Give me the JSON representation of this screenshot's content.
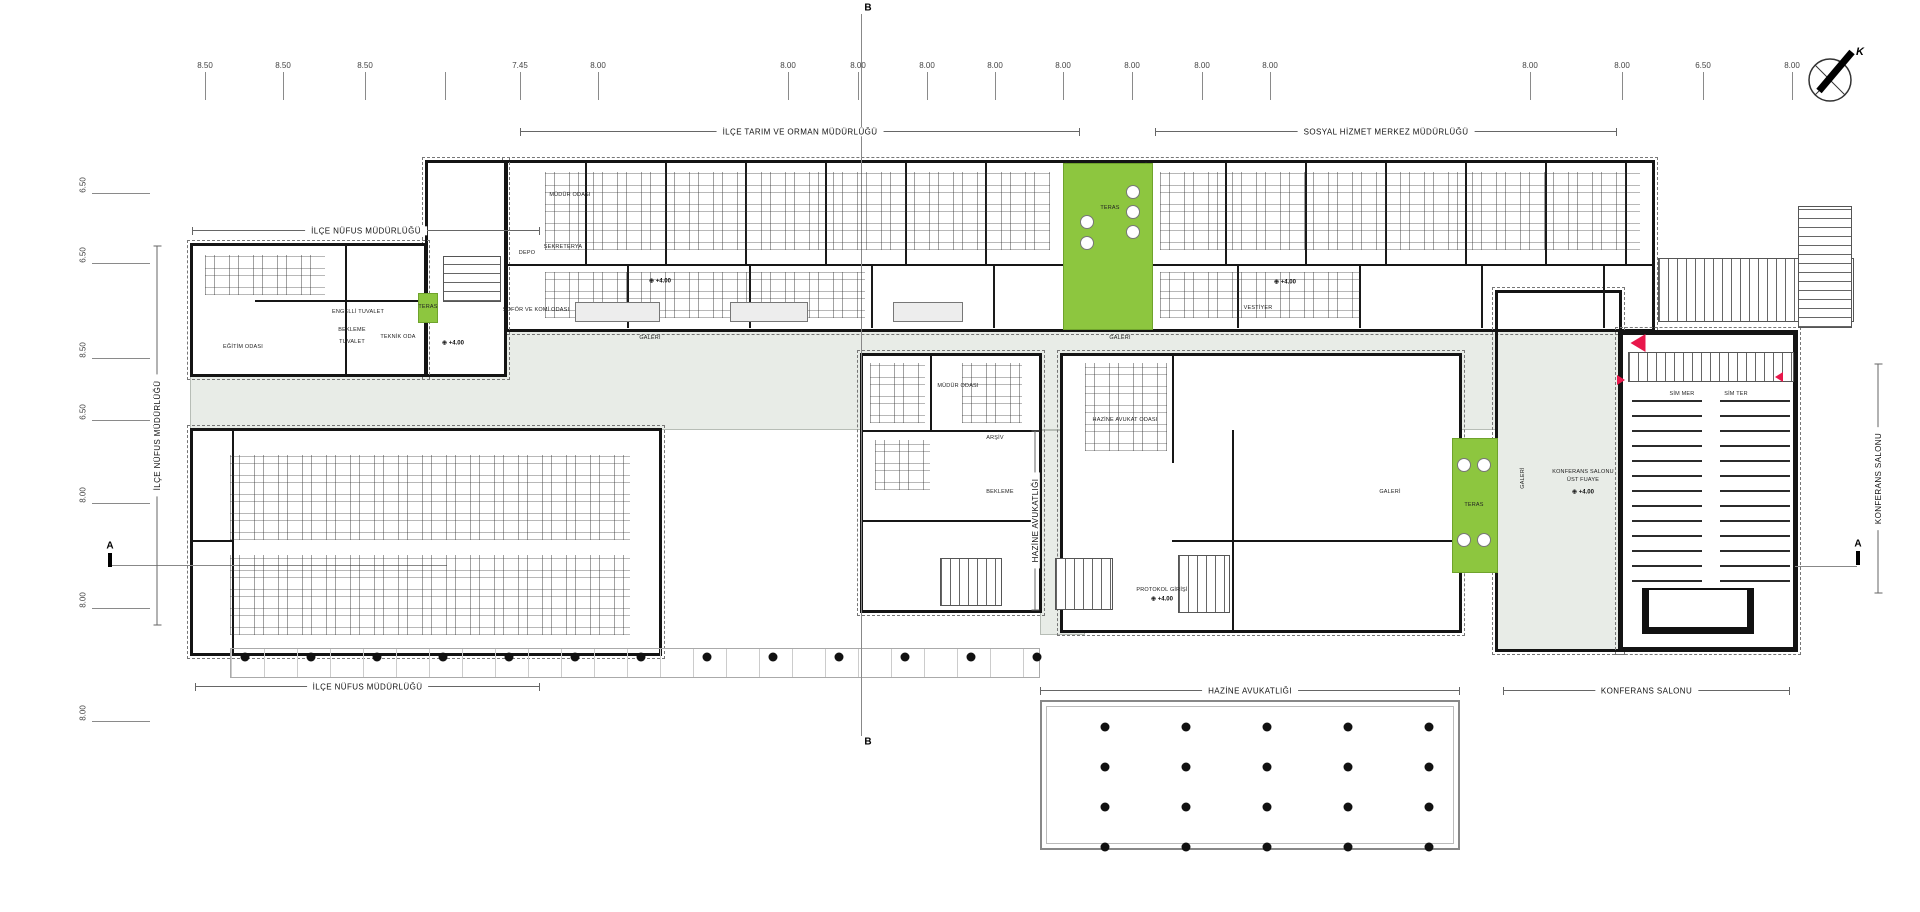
{
  "colors": {
    "green": "#8dc63f",
    "red": "#e8174b",
    "corridor": "#e8ece7",
    "wall": "#141414"
  },
  "compass": {
    "label": "K"
  },
  "sections": {
    "a": "A",
    "b": "B"
  },
  "dims_top": [
    {
      "x": 205,
      "v": "8.50"
    },
    {
      "x": 283,
      "v": "8.50"
    },
    {
      "x": 365,
      "v": "8.50"
    },
    {
      "x": 445,
      "v": ""
    },
    {
      "x": 520,
      "v": "7.45"
    },
    {
      "x": 598,
      "v": "8.00"
    },
    {
      "x": 788,
      "v": "8.00"
    },
    {
      "x": 858,
      "v": "8.00"
    },
    {
      "x": 927,
      "v": "8.00"
    },
    {
      "x": 995,
      "v": "8.00"
    },
    {
      "x": 1063,
      "v": "8.00"
    },
    {
      "x": 1132,
      "v": "8.00"
    },
    {
      "x": 1202,
      "v": "8.00"
    },
    {
      "x": 1270,
      "v": "8.00"
    },
    {
      "x": 1530,
      "v": "8.00"
    },
    {
      "x": 1622,
      "v": "8.00"
    },
    {
      "x": 1703,
      "v": "6.50"
    },
    {
      "x": 1792,
      "v": "8.00"
    }
  ],
  "dims_left": [
    {
      "y": 185,
      "v": "6.50"
    },
    {
      "y": 255,
      "v": "6.50"
    },
    {
      "y": 350,
      "v": "8.50"
    },
    {
      "y": 412,
      "v": "6.50"
    },
    {
      "y": 495,
      "v": "8.00"
    },
    {
      "y": 600,
      "v": "8.00"
    },
    {
      "y": 713,
      "v": "8.00"
    }
  ],
  "dept_lines": [
    {
      "x1": 520,
      "x2": 1080,
      "y": 131,
      "t": "İLÇE TARIM VE ORMAN MÜDÜRLÜĞÜ"
    },
    {
      "x1": 1155,
      "x2": 1617,
      "y": 131,
      "t": "SOSYAL HİZMET MERKEZ MÜDÜRLÜĞÜ"
    },
    {
      "x1": 192,
      "x2": 540,
      "y": 230,
      "t": "İLÇE NÜFUS MÜDÜRLÜĞÜ"
    },
    {
      "x1": 195,
      "x2": 540,
      "y": 686,
      "t": "İLÇE NÜFUS MÜDÜRLÜĞÜ"
    },
    {
      "x1": 1040,
      "x2": 1460,
      "y": 690,
      "t": "HAZİNE AVUKATLIĞI"
    },
    {
      "x1": 1503,
      "x2": 1790,
      "y": 690,
      "t": "KONFERANS SALONU"
    }
  ],
  "side_labels": [
    {
      "x": 157,
      "y": 435,
      "len": 380,
      "t": "İLÇE NÜFUS MÜDÜRLÜĞÜ"
    },
    {
      "x": 1035,
      "y": 520,
      "len": 180,
      "t": "HAZİNE AVUKATLIĞI"
    },
    {
      "x": 1878,
      "y": 478,
      "len": 230,
      "t": "KONFERANS SALONU"
    }
  ],
  "room_labels": [
    {
      "x": 650,
      "y": 338,
      "t": "GALERİ"
    },
    {
      "x": 1120,
      "y": 338,
      "t": "GALERİ"
    },
    {
      "x": 1390,
      "y": 492,
      "t": "GALERİ"
    },
    {
      "x": 1523,
      "y": 478,
      "t": "GALERİ",
      "rot": -90
    },
    {
      "x": 352,
      "y": 330,
      "t": "BEKLEME"
    },
    {
      "x": 1000,
      "y": 492,
      "t": "BEKLEME"
    },
    {
      "x": 358,
      "y": 312,
      "t": "ENGELLİ TUVALET"
    },
    {
      "x": 352,
      "y": 342,
      "t": "TUVALET"
    },
    {
      "x": 398,
      "y": 337,
      "t": "TEKNİK ODA"
    },
    {
      "x": 243,
      "y": 347,
      "t": "EĞİTİM ODASI"
    },
    {
      "x": 563,
      "y": 247,
      "t": "SEKRETERYA"
    },
    {
      "x": 527,
      "y": 253,
      "t": "DEPO"
    },
    {
      "x": 570,
      "y": 195,
      "t": "MÜDÜR ODASI"
    },
    {
      "x": 536,
      "y": 310,
      "t": "ŞOFÖR VE KOMİ ODASI"
    },
    {
      "x": 1258,
      "y": 308,
      "t": "VESTİYER"
    },
    {
      "x": 1125,
      "y": 420,
      "t": "HAZİNE AVUKAT ODASI"
    },
    {
      "x": 958,
      "y": 386,
      "t": "MÜDÜR ODASI"
    },
    {
      "x": 995,
      "y": 438,
      "t": "ARŞİV"
    },
    {
      "x": 1162,
      "y": 590,
      "t": "PROTOKOL GİRİŞİ"
    },
    {
      "x": 1682,
      "y": 394,
      "t": "SİM MER"
    },
    {
      "x": 1736,
      "y": 394,
      "t": "SİM TER"
    },
    {
      "x": 1583,
      "y": 472,
      "t": "KONFERANS SALONU"
    },
    {
      "x": 1583,
      "y": 480,
      "t": "ÜST FUAYE"
    }
  ],
  "level_markers": [
    {
      "x": 453,
      "y": 343,
      "sym": "⊕",
      "label": "+4.00"
    },
    {
      "x": 660,
      "y": 281,
      "sym": "⊕",
      "label": "+4.00"
    },
    {
      "x": 1285,
      "y": 282,
      "sym": "⊕",
      "label": "+4.00"
    },
    {
      "x": 1583,
      "y": 492,
      "sym": "⊕",
      "label": "+4.00"
    },
    {
      "x": 1162,
      "y": 599,
      "sym": "⊕",
      "label": "+4.00"
    }
  ],
  "terraces": [
    {
      "x": 1063,
      "y": 163,
      "w": 90,
      "h": 167,
      "label": "TERAS",
      "lx": 1110,
      "ly": 208,
      "circles": [
        [
          1133,
          192
        ],
        [
          1133,
          212
        ],
        [
          1133,
          232
        ],
        [
          1087,
          222
        ],
        [
          1087,
          243
        ]
      ]
    },
    {
      "x": 418,
      "y": 293,
      "w": 20,
      "h": 30,
      "label": "TERAS",
      "lx": 428,
      "ly": 307,
      "circles": []
    },
    {
      "x": 1452,
      "y": 438,
      "w": 46,
      "h": 135,
      "label": "TERAS",
      "lx": 1474,
      "ly": 505,
      "circles": [
        [
          1464,
          465
        ],
        [
          1484,
          465
        ],
        [
          1464,
          540
        ],
        [
          1484,
          540
        ]
      ]
    }
  ],
  "red_markers": [
    {
      "x": 1638,
      "y": 343,
      "dir": "left",
      "s": 15
    },
    {
      "x": 1621,
      "y": 380,
      "dir": "right",
      "s": 8
    },
    {
      "x": 1779,
      "y": 377,
      "dir": "left",
      "s": 8
    }
  ],
  "column_grids": [
    {
      "x0": 1105,
      "y0": 727,
      "dx": 81,
      "dy": 40,
      "cols": 5,
      "rows": 4
    },
    {
      "x0": 245,
      "y0": 657,
      "dx": 66,
      "dy": 0,
      "cols": 13,
      "rows": 1
    }
  ],
  "blocks": [
    {
      "x": 190,
      "y": 330,
      "w": 1310,
      "h": 100,
      "cls": "corr"
    },
    {
      "x": 1495,
      "y": 290,
      "w": 127,
      "h": 362,
      "cls": "corr"
    },
    {
      "x": 1040,
      "y": 430,
      "w": 45,
      "h": 205,
      "cls": "corr"
    },
    {
      "x": 1620,
      "y": 332,
      "w": 176,
      "h": 54,
      "cls": "corr"
    },
    {
      "x": 505,
      "y": 160,
      "w": 1150,
      "h": 172,
      "cls": "wing"
    },
    {
      "x": 425,
      "y": 160,
      "w": 82,
      "h": 217,
      "cls": "wing"
    },
    {
      "x": 190,
      "y": 243,
      "w": 237,
      "h": 134,
      "cls": "wing"
    },
    {
      "x": 190,
      "y": 428,
      "w": 472,
      "h": 228,
      "cls": "wing"
    },
    {
      "x": 860,
      "y": 353,
      "w": 182,
      "h": 260,
      "cls": "wing"
    },
    {
      "x": 1060,
      "y": 353,
      "w": 402,
      "h": 280,
      "cls": "wing"
    },
    {
      "x": 1495,
      "y": 290,
      "w": 127,
      "h": 362,
      "cls": "wing clear"
    },
    {
      "x": 1618,
      "y": 330,
      "w": 180,
      "h": 322,
      "cls": "wing thick"
    },
    {
      "x": 507,
      "y": 162,
      "w": 1146,
      "h": 102,
      "cls": "pv78"
    },
    {
      "x": 507,
      "y": 264,
      "w": 1146,
      "h": 2,
      "cls": "wall"
    },
    {
      "x": 507,
      "y": 266,
      "w": 1146,
      "h": 62,
      "cls": "pv120"
    },
    {
      "x": 232,
      "y": 430,
      "w": 2,
      "h": 224,
      "cls": "wall"
    },
    {
      "x": 190,
      "y": 540,
      "w": 42,
      "h": 2,
      "cls": "wall"
    },
    {
      "x": 862,
      "y": 430,
      "w": 180,
      "h": 2,
      "cls": "wall"
    },
    {
      "x": 862,
      "y": 520,
      "w": 180,
      "h": 2,
      "cls": "wall"
    },
    {
      "x": 930,
      "y": 355,
      "w": 2,
      "h": 75,
      "cls": "wall"
    },
    {
      "x": 1172,
      "y": 355,
      "w": 2,
      "h": 108,
      "cls": "wall"
    },
    {
      "x": 1232,
      "y": 430,
      "w": 2,
      "h": 203,
      "cls": "wall"
    },
    {
      "x": 1172,
      "y": 540,
      "w": 288,
      "h": 2,
      "cls": "wall"
    },
    {
      "x": 345,
      "y": 245,
      "w": 2,
      "h": 130,
      "cls": "wall"
    },
    {
      "x": 255,
      "y": 300,
      "w": 170,
      "h": 2,
      "cls": "wall"
    },
    {
      "x": 1658,
      "y": 258,
      "w": 196,
      "h": 64,
      "cls": "st-h"
    },
    {
      "x": 1798,
      "y": 206,
      "w": 54,
      "h": 122,
      "cls": "st-v"
    },
    {
      "x": 1628,
      "y": 352,
      "w": 166,
      "h": 30,
      "cls": "st-h"
    },
    {
      "x": 443,
      "y": 256,
      "w": 58,
      "h": 46,
      "cls": "st-v"
    },
    {
      "x": 1178,
      "y": 555,
      "w": 52,
      "h": 58,
      "cls": "st-h"
    },
    {
      "x": 940,
      "y": 558,
      "w": 62,
      "h": 48,
      "cls": "st-h"
    },
    {
      "x": 1055,
      "y": 558,
      "w": 58,
      "h": 52,
      "cls": "st-h"
    },
    {
      "x": 230,
      "y": 648,
      "w": 810,
      "h": 30,
      "cls": "colonnade"
    },
    {
      "x": 1040,
      "y": 700,
      "w": 420,
      "h": 150,
      "cls": "terrace-open"
    },
    {
      "x": 861,
      "y": 14,
      "w": 1,
      "h": 722,
      "cls": "gline"
    },
    {
      "x": 112,
      "y": 565,
      "w": 335,
      "h": 1,
      "cls": "gline"
    },
    {
      "x": 1795,
      "y": 566,
      "w": 62,
      "h": 1,
      "cls": "gline"
    },
    {
      "x": 108,
      "y": 553,
      "w": 4,
      "h": 14,
      "cls": "bar"
    },
    {
      "x": 1856,
      "y": 551,
      "w": 4,
      "h": 14,
      "cls": "bar"
    }
  ],
  "furniture": [
    {
      "x": 545,
      "y": 172,
      "w": 505,
      "h": 78,
      "type": "desks"
    },
    {
      "x": 1160,
      "y": 172,
      "w": 480,
      "h": 78,
      "type": "desks"
    },
    {
      "x": 545,
      "y": 272,
      "w": 320,
      "h": 46,
      "type": "desks"
    },
    {
      "x": 1160,
      "y": 272,
      "w": 200,
      "h": 46,
      "type": "desks"
    },
    {
      "x": 230,
      "y": 455,
      "w": 400,
      "h": 85,
      "type": "desks"
    },
    {
      "x": 230,
      "y": 555,
      "w": 400,
      "h": 80,
      "type": "desks"
    },
    {
      "x": 205,
      "y": 255,
      "w": 120,
      "h": 40,
      "type": "desks"
    },
    {
      "x": 870,
      "y": 363,
      "w": 55,
      "h": 60,
      "type": "desks"
    },
    {
      "x": 962,
      "y": 363,
      "w": 60,
      "h": 60,
      "type": "desks"
    },
    {
      "x": 875,
      "y": 440,
      "w": 55,
      "h": 50,
      "type": "desks"
    },
    {
      "x": 1085,
      "y": 363,
      "w": 82,
      "h": 88,
      "type": "desks"
    },
    {
      "x": 575,
      "y": 302,
      "w": 85,
      "h": 20,
      "type": "table"
    },
    {
      "x": 730,
      "y": 302,
      "w": 78,
      "h": 20,
      "type": "table"
    },
    {
      "x": 893,
      "y": 302,
      "w": 70,
      "h": 20,
      "type": "table"
    },
    {
      "x": 1632,
      "y": 390,
      "w": 158,
      "h": 192,
      "type": "seats"
    },
    {
      "x": 1642,
      "y": 588,
      "w": 112,
      "h": 46,
      "type": "stage"
    }
  ]
}
